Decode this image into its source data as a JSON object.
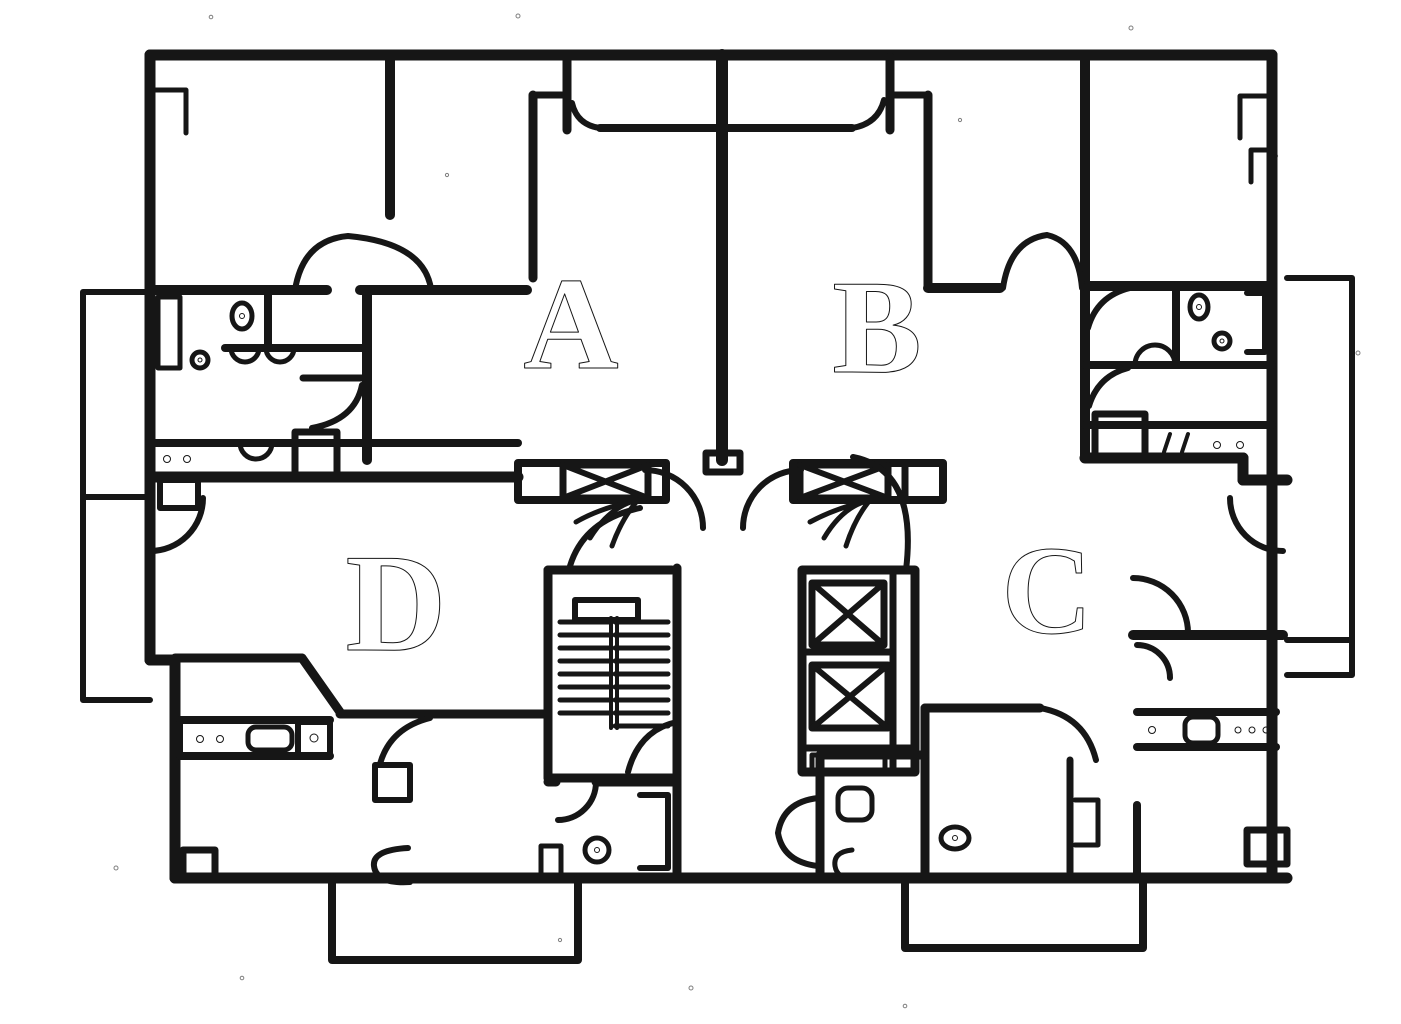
{
  "page": {
    "title": "Hand-drawn apartment floor plan sketch"
  },
  "colors": {
    "ink": "#161616",
    "paper": "#ffffff"
  },
  "units": [
    {
      "label": "A",
      "position": "upper-left unit"
    },
    {
      "label": "B",
      "position": "upper-right unit"
    },
    {
      "label": "C",
      "position": "lower-right unit"
    },
    {
      "label": "D",
      "position": "lower-left unit"
    }
  ],
  "core_symbols": {
    "staircase": "stair-flight with treads and landing",
    "elevators": "two shafts marked with X",
    "vent_shafts": "crossed duct boxes beside entry doors",
    "doors": "quarter-circle swing arcs",
    "balconies": "left, right and two bottom balconies"
  }
}
